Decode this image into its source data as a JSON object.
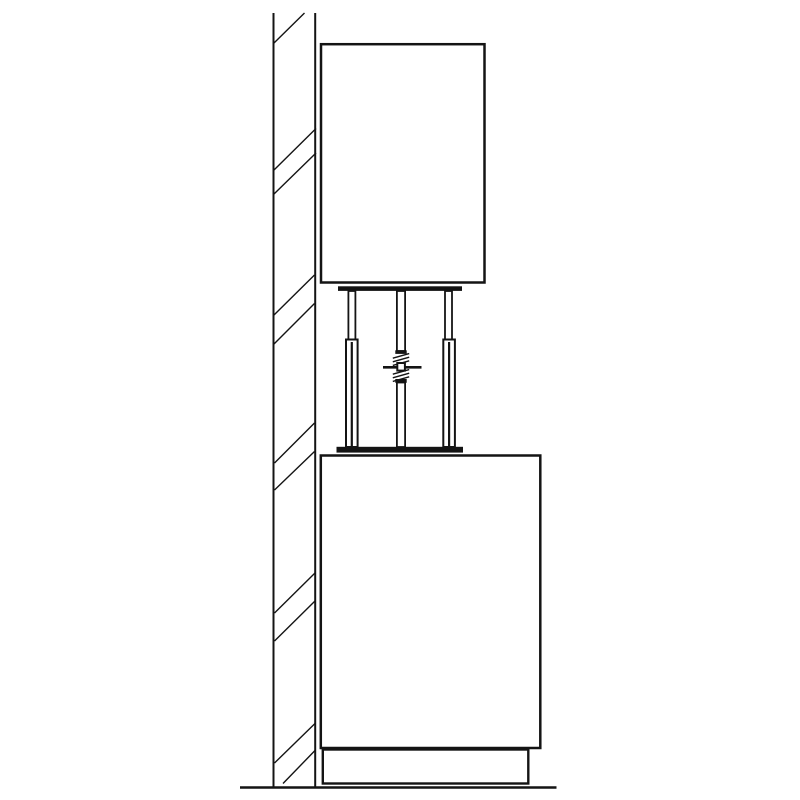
{
  "app": {
    "background": "#ffffff",
    "ink": "#141414"
  },
  "drawing": {
    "width": 800,
    "height": 800,
    "elements": [
      {
        "name": "wall-outer-edge-line",
        "type": "line",
        "x1": 273.5,
        "y1": 13,
        "x2": 273.5,
        "y2": 787,
        "w": 2.0
      },
      {
        "name": "wall-inner-edge-line",
        "type": "line",
        "x1": 315.2,
        "y1": 13,
        "x2": 315.2,
        "y2": 787,
        "w": 2.0
      },
      {
        "name": "wall-hatch-mark",
        "type": "line",
        "x1": 274.0,
        "y1": 43.0,
        "x2": 304.5,
        "y2": 13.0,
        "w": 1.4
      },
      {
        "name": "wall-hatch-mark",
        "type": "line",
        "x1": 274.0,
        "y1": 170.0,
        "x2": 316.0,
        "y2": 128.5,
        "w": 1.4
      },
      {
        "name": "wall-hatch-mark",
        "type": "line",
        "x1": 274.0,
        "y1": 194.0,
        "x2": 316.0,
        "y2": 153.0,
        "w": 1.4
      },
      {
        "name": "wall-hatch-mark",
        "type": "line",
        "x1": 274.0,
        "y1": 315.0,
        "x2": 314.5,
        "y2": 275.0,
        "w": 1.4
      },
      {
        "name": "wall-hatch-mark",
        "type": "line",
        "x1": 274.0,
        "y1": 344.0,
        "x2": 314.5,
        "y2": 303.5,
        "w": 1.4
      },
      {
        "name": "wall-hatch-mark",
        "type": "line",
        "x1": 274.5,
        "y1": 463.0,
        "x2": 314.5,
        "y2": 423.0,
        "w": 1.4
      },
      {
        "name": "wall-hatch-mark",
        "type": "line",
        "x1": 274.5,
        "y1": 490.0,
        "x2": 314.5,
        "y2": 451.5,
        "w": 1.4
      },
      {
        "name": "wall-hatch-mark",
        "type": "line",
        "x1": 274.5,
        "y1": 613.0,
        "x2": 315.0,
        "y2": 573.0,
        "w": 1.4
      },
      {
        "name": "wall-hatch-mark",
        "type": "line",
        "x1": 274.5,
        "y1": 641.0,
        "x2": 315.0,
        "y2": 601.0,
        "w": 1.4
      },
      {
        "name": "wall-hatch-mark",
        "type": "line",
        "x1": 274.5,
        "y1": 763.0,
        "x2": 315.0,
        "y2": 723.5,
        "w": 1.4
      },
      {
        "name": "wall-hatch-mark",
        "type": "line",
        "x1": 283.0,
        "y1": 783.5,
        "x2": 315.0,
        "y2": 750.5,
        "w": 1.4
      },
      {
        "name": "floor-line",
        "type": "line",
        "x1": 240,
        "y1": 787.5,
        "x2": 556.5,
        "y2": 787.5,
        "w": 2.6
      },
      {
        "name": "upper-cabinet-outline",
        "type": "rect",
        "x": 321.0,
        "y": 44.2,
        "wd": 163.5,
        "ht": 238.3,
        "w": 2.5,
        "fill": "#ffffff"
      },
      {
        "name": "lower-cabinet-outline",
        "type": "rect",
        "x": 320.8,
        "y": 455.5,
        "wd": 219.5,
        "ht": 292.5,
        "w": 2.5,
        "fill": "#ffffff"
      },
      {
        "name": "plinth-outline",
        "type": "rect",
        "x": 322.8,
        "y": 749.5,
        "wd": 205.5,
        "ht": 34.0,
        "w": 2.4,
        "fill": "#ffffff"
      },
      {
        "name": "left-leg-upper-rod",
        "type": "rect",
        "x": 348.4,
        "y": 291.0,
        "wd": 7.0,
        "ht": 50.0,
        "w": 1.8,
        "fill": "#ffffff"
      },
      {
        "name": "right-leg-upper-rod",
        "type": "rect",
        "x": 445.0,
        "y": 291.0,
        "wd": 7.0,
        "ht": 50.0,
        "w": 1.8,
        "fill": "#ffffff"
      },
      {
        "name": "left-leg-outer-tube",
        "type": "rect",
        "x": 346.0,
        "y": 339.5,
        "wd": 11.6,
        "ht": 107.5,
        "w": 2.0,
        "fill": "#ffffff"
      },
      {
        "name": "left-leg-inner-line",
        "type": "line",
        "x1": 351.8,
        "y1": 342.0,
        "x2": 351.8,
        "y2": 446.5,
        "w": 2.2
      },
      {
        "name": "right-leg-outer-tube",
        "type": "rect",
        "x": 443.3,
        "y": 339.5,
        "wd": 11.6,
        "ht": 107.5,
        "w": 2.0,
        "fill": "#ffffff"
      },
      {
        "name": "right-leg-inner-line",
        "type": "line",
        "x1": 449.1,
        "y1": 342.0,
        "x2": 449.1,
        "y2": 446.5,
        "w": 2.2
      },
      {
        "name": "spindle-upper-tube",
        "type": "rect",
        "x": 396.9,
        "y": 291.0,
        "wd": 8.2,
        "ht": 60.0,
        "w": 1.8,
        "fill": "#ffffff"
      },
      {
        "name": "spindle-lower-tube",
        "type": "rect",
        "x": 396.9,
        "y": 382.5,
        "wd": 8.2,
        "ht": 64.5,
        "w": 1.8,
        "fill": "#ffffff"
      },
      {
        "name": "mount-top-plate",
        "type": "rect",
        "x": 338.0,
        "y": 286.3,
        "wd": 124.0,
        "ht": 4.6,
        "w": 0,
        "fill": "ink"
      },
      {
        "name": "mount-bottom-plate",
        "type": "rect",
        "x": 336.5,
        "y": 446.8,
        "wd": 126.5,
        "ht": 5.8,
        "w": 0,
        "fill": "ink"
      },
      {
        "name": "spindle-upper-cap",
        "type": "rect",
        "x": 395.3,
        "y": 350.3,
        "wd": 11.4,
        "ht": 3.6,
        "w": 0,
        "fill": "ink"
      },
      {
        "name": "spindle-lower-cap",
        "type": "rect",
        "x": 395.3,
        "y": 379.0,
        "wd": 11.4,
        "ht": 3.8,
        "w": 0,
        "fill": "ink"
      },
      {
        "name": "spindle-thread-mark",
        "type": "line",
        "x1": 392.8,
        "y1": 358.2,
        "x2": 409.2,
        "y2": 353.6,
        "w": 1.4
      },
      {
        "name": "spindle-thread-mark",
        "type": "line",
        "x1": 392.8,
        "y1": 361.8,
        "x2": 409.2,
        "y2": 357.2,
        "w": 1.4
      },
      {
        "name": "spindle-thread-mark",
        "type": "line",
        "x1": 392.8,
        "y1": 365.4,
        "x2": 409.2,
        "y2": 360.8,
        "w": 1.4
      },
      {
        "name": "spindle-thread-mark",
        "type": "line",
        "x1": 392.8,
        "y1": 374.2,
        "x2": 409.2,
        "y2": 369.6,
        "w": 1.4
      },
      {
        "name": "spindle-thread-mark",
        "type": "line",
        "x1": 392.8,
        "y1": 377.8,
        "x2": 409.2,
        "y2": 373.2,
        "w": 1.4
      },
      {
        "name": "spindle-thread-mark",
        "type": "line",
        "x1": 392.8,
        "y1": 381.4,
        "x2": 409.2,
        "y2": 376.8,
        "w": 1.4
      },
      {
        "name": "spindle-handle",
        "type": "line",
        "x1": 383.0,
        "y1": 367.3,
        "x2": 421.5,
        "y2": 367.3,
        "w": 2.7
      },
      {
        "name": "adjusting-nut",
        "type": "rect",
        "x": 397.3,
        "y": 363.0,
        "wd": 7.6,
        "ht": 7.6,
        "w": 2.0,
        "fill": "#ffffff"
      }
    ]
  }
}
